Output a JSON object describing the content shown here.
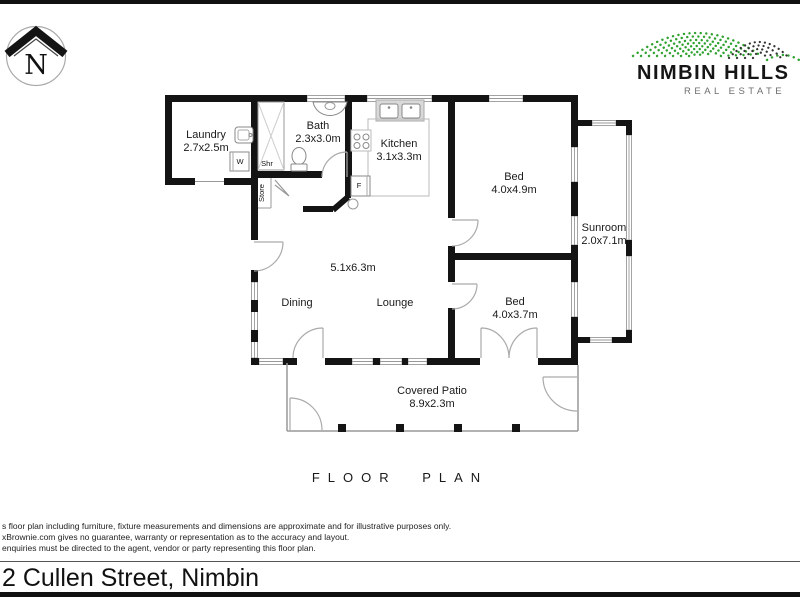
{
  "compass": {
    "letter": "N"
  },
  "logo": {
    "name_line": "NIMBIN HILLS",
    "tagline": "REAL ESTATE"
  },
  "rooms": {
    "laundry": {
      "name": "Laundry",
      "dims": "2.7x2.5m"
    },
    "bath": {
      "name": "Bath",
      "dims": "2.3x3.0m"
    },
    "kitchen": {
      "name": "Kitchen",
      "dims": "3.1x3.3m"
    },
    "bed1": {
      "name": "Bed",
      "dims": "4.0x4.9m"
    },
    "bed2": {
      "name": "Bed",
      "dims": "4.0x3.7m"
    },
    "sunroom": {
      "name": "Sunroom",
      "dims": "2.0x7.1m"
    },
    "living": {
      "dims": "5.1x6.3m",
      "area1": "Dining",
      "area2": "Lounge"
    },
    "patio": {
      "name": "Covered Patio",
      "dims": "8.9x2.3m"
    }
  },
  "fixtures": {
    "shower": "Shr",
    "store": "Store",
    "washer": "W",
    "fridge": "F"
  },
  "title": "FLOOR PLAN",
  "disclaimer": {
    "line1": "s floor plan including furniture, fixture measurements and dimensions are approximate and for illustrative purposes only.",
    "line2": "xBrownie.com gives no guarantee, warranty or representation as to the accuracy and layout.",
    "line3": "enquiries must be directed to the agent, vendor or party representing this floor plan."
  },
  "address": "2 Cullen Street, Nimbin",
  "colors": {
    "wall": "#141414",
    "logo_green": "#2ea22e",
    "logo_dark": "#333333",
    "thin_line": "#999999"
  }
}
